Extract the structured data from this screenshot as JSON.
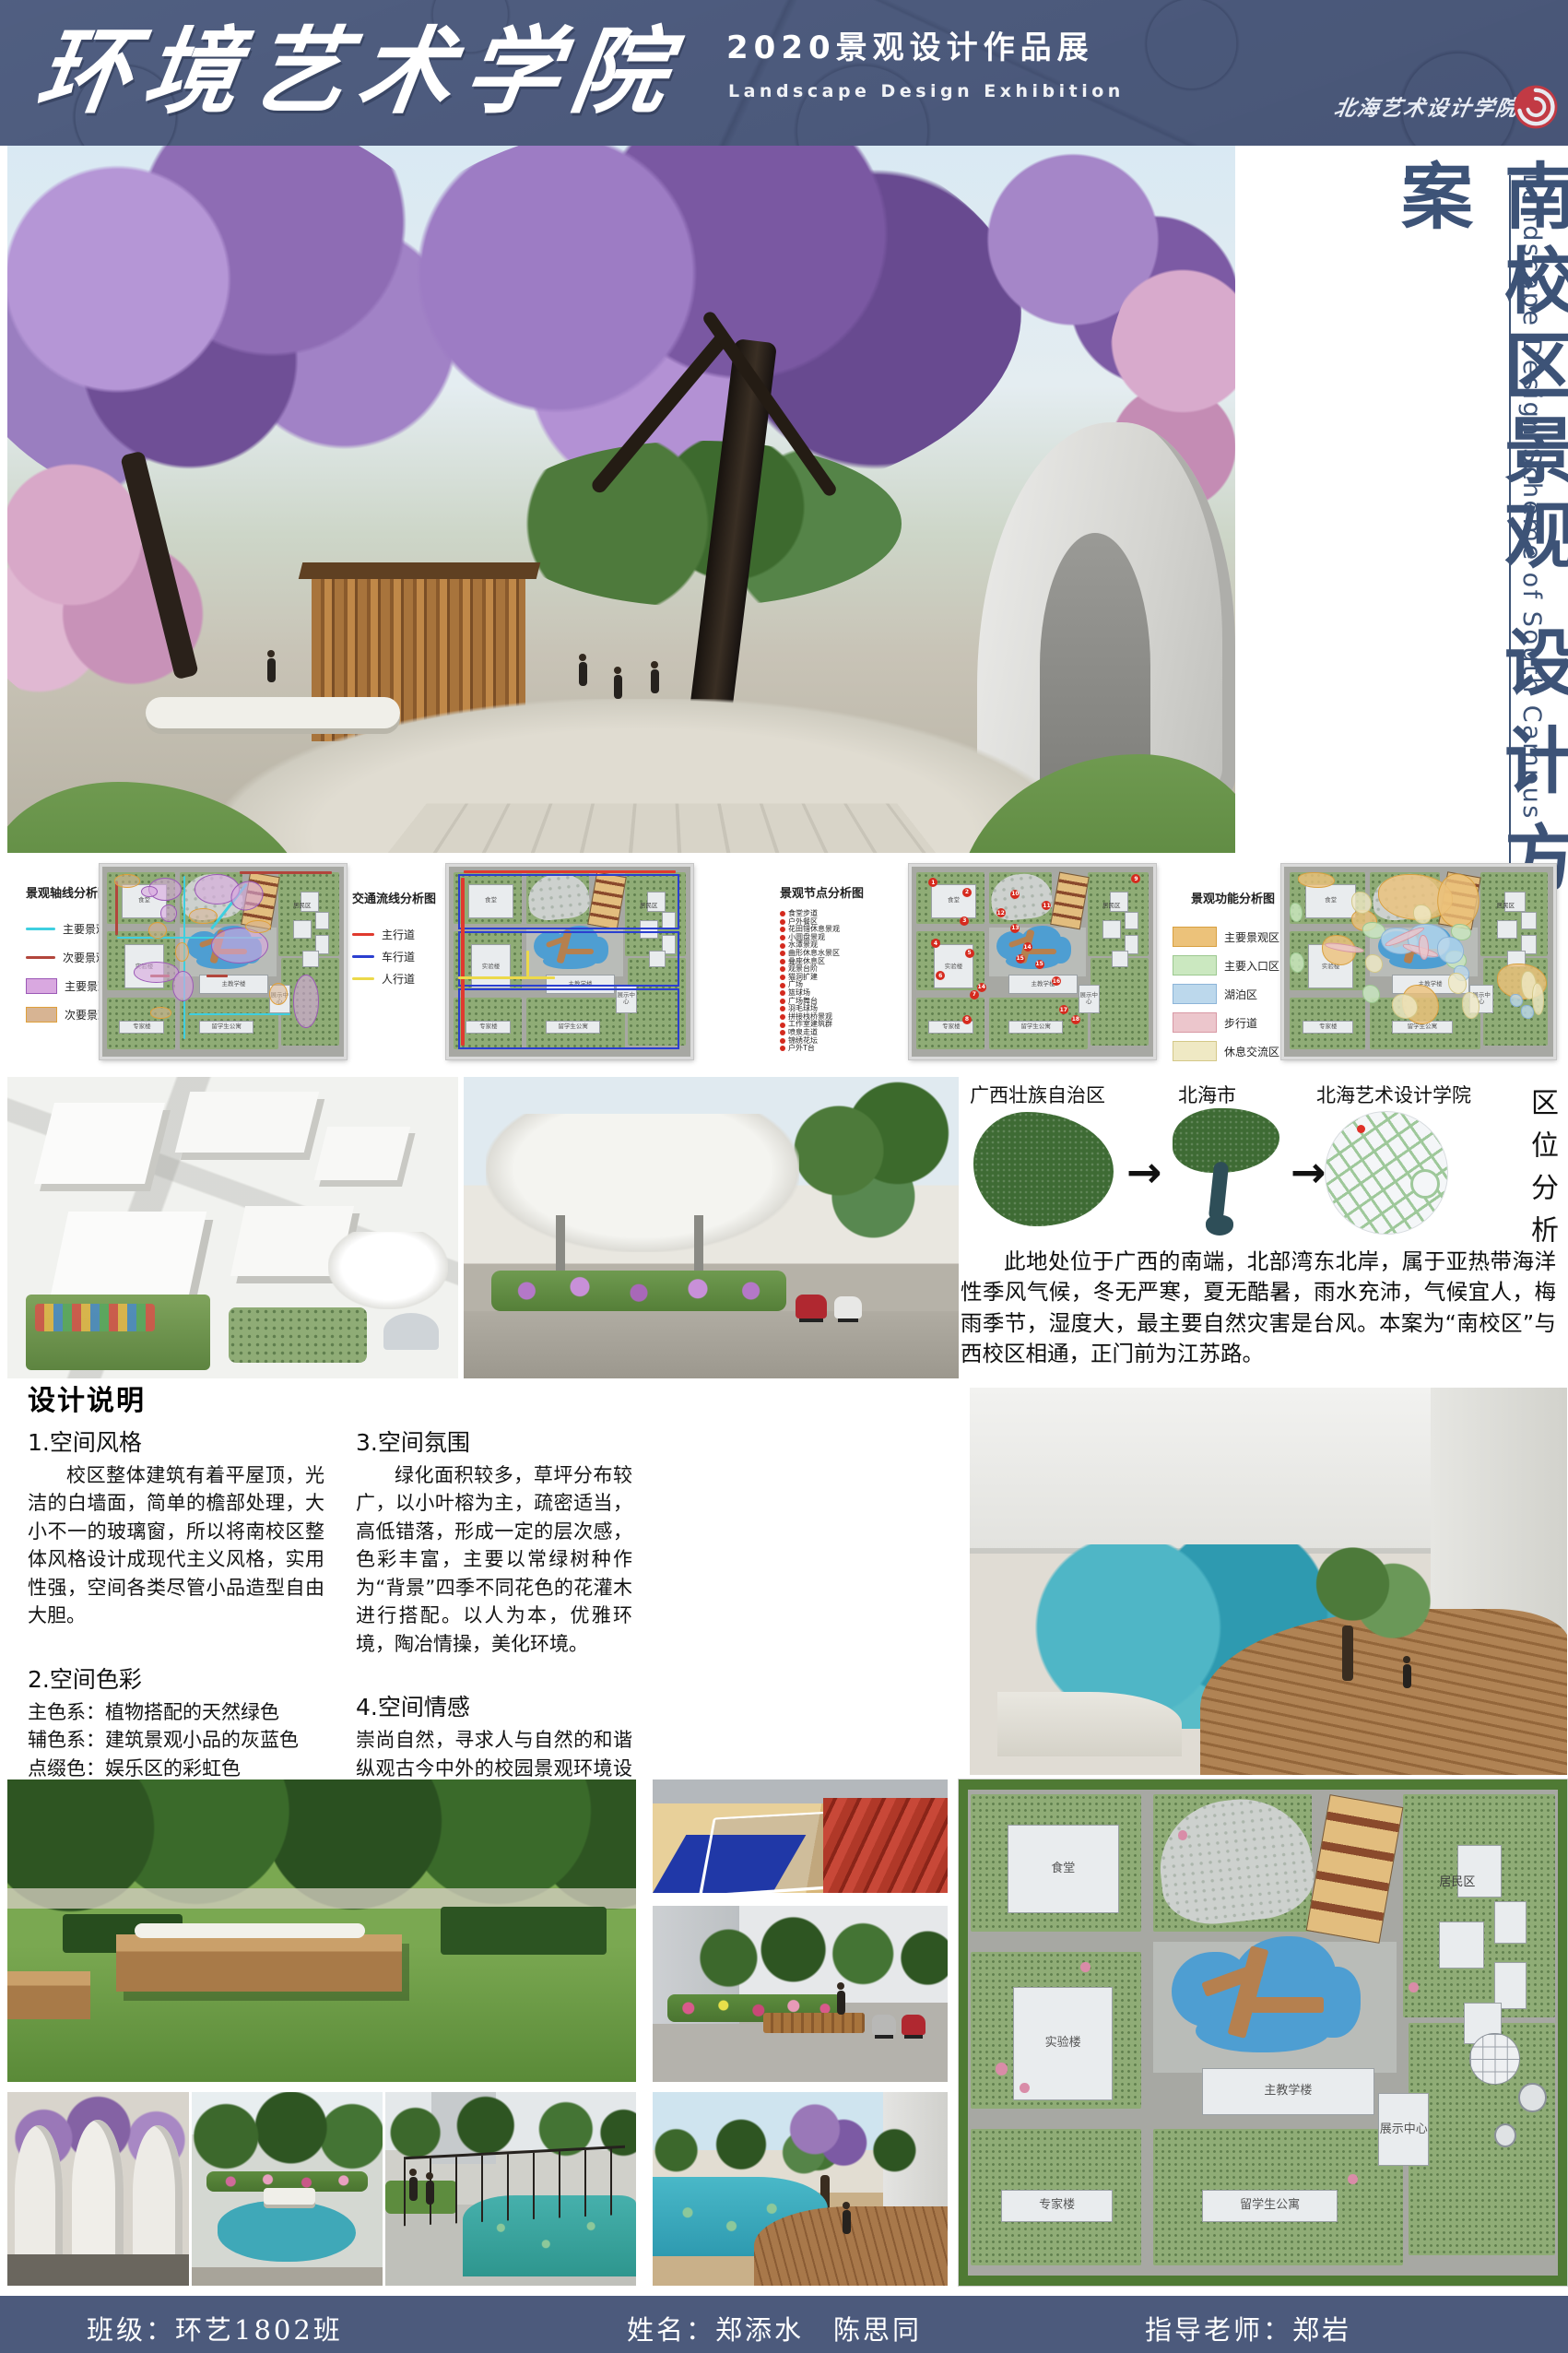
{
  "header": {
    "school_name": "环境艺术学院",
    "exhibition_title_zh": "2020景观设计作品展",
    "exhibition_title_en": "Landscape Design Exhibition",
    "logo_text": "北海艺术设计学院"
  },
  "side_title": {
    "zh_line1": "南校区景观",
    "zh_line2": "设计方案",
    "en": "Landscape Design Scheme of South Campus"
  },
  "icons": {
    "arrow_right": "→"
  },
  "diagrams": [
    {
      "title": "景观轴线分析图",
      "legend": [
        {
          "label": "主要景观轴线",
          "type": "line",
          "color": "#3ecfe0"
        },
        {
          "label": "次要景观轴线",
          "type": "line",
          "color": "#b2463c"
        },
        {
          "label": "主要景观节点",
          "type": "box",
          "color": "#d9a8e0",
          "border": "#9b59b6"
        },
        {
          "label": "次要景观节点",
          "type": "box",
          "color": "#d7b493",
          "border": "#e0a03a"
        }
      ]
    },
    {
      "title": "交通流线分析图",
      "legend": [
        {
          "label": "主行道",
          "type": "line",
          "color": "#e03a2e"
        },
        {
          "label": "车行道",
          "type": "line",
          "color": "#2b3fd0"
        },
        {
          "label": "人行道",
          "type": "line",
          "color": "#ecd94a"
        }
      ]
    },
    {
      "title": "景观节点分析图",
      "nodes": [
        "食堂步道",
        "户外餐区",
        "花田错休息景观",
        "小圆盘景观",
        "水潭景观",
        "曲形休息水景区",
        "叠座休息区",
        "观景台阶",
        "猫洞扩建",
        "广场",
        "篮球场",
        "广场舞台",
        "羽毛球场",
        "拼接栈桥景观",
        "工作室建筑群",
        "喷泉走道",
        "锦绣花坛",
        "户外T台"
      ]
    },
    {
      "title": "景观功能分析图",
      "legend": [
        {
          "label": "主要景观区",
          "type": "box",
          "color": "#ecc27a",
          "border": "#d8a040"
        },
        {
          "label": "主要入口区",
          "type": "box",
          "color": "#cbe8c0",
          "border": "#9cc890"
        },
        {
          "label": "湖泊区",
          "type": "box",
          "color": "#bcd8ec",
          "border": "#8cb4d8"
        },
        {
          "label": "步行道",
          "type": "box",
          "color": "#ecc6cc",
          "border": "#d898a4"
        },
        {
          "label": "休息交流区",
          "type": "box",
          "color": "#efe9c4",
          "border": "#d4c888"
        }
      ]
    }
  ],
  "plan_labels": {
    "canteen": "食堂",
    "lab": "实验楼",
    "main_teaching": "主教学楼",
    "expert": "专家楼",
    "intl_dorm": "留学生公寓",
    "exhibition_center": "展示中心",
    "residential": "居民区"
  },
  "location": {
    "title_vertical": "区位分析",
    "steps": [
      "广西壮族自治区",
      "北海市",
      "北海艺术设计学院"
    ],
    "description": "此地处位于广西的南端，北部湾东北岸，属于亚热带海洋性季风气候，冬无严寒，夏无酷暑，雨水充沛，气候宜人，梅雨季节，湿度大，最主要自然灾害是台风。本案为“南校区”与西校区相通，正门前为江苏路。"
  },
  "design_notes": {
    "title": "设计说明",
    "sections": [
      {
        "heading": "1.空间风格",
        "body": "校区整体建筑有着平屋顶，光洁的白墙面，简单的檐部处理，大小不一的玻璃窗，所以将南校区整体风格设计成现代主义风格，实用性强，空间各类尽管小品造型自由大胆。"
      },
      {
        "heading": "2.空间色彩",
        "body": "主色系：植物搭配的天然绿色\n辅色系：建筑景观小品的灰蓝色\n点缀色：娱乐区的彩虹色"
      },
      {
        "heading": "3.空间氛围",
        "body": "绿化面积较多，草坪分布较广，以小叶榕为主，疏密适当，高低错落，形成一定的层次感，色彩丰富，主要以常绿树种作为“背景”四季不同花色的花灌木进行搭配。以人为本，优雅环境，陶冶情操，美化环境。"
      },
      {
        "heading": "4.空间情感",
        "body": "崇尚自然，寻求人与自然的和谐纵观古今中外的校园景观环境设计，都以“接近自然，回归自然”作为设计法则。贯穿于整个设计与建造中。只有在有限的生活空间利用自然，师法自然，寻求人与山水，建筑小品，植物之间的和谐共处，才能使环境有融于自然之感，达到人和自然的和谐。"
      }
    ]
  },
  "footer": {
    "class_label": "班级：环艺1802班",
    "names_label": "姓名：郑添水　陈思同",
    "advisor_label": "指导老师：郑岩"
  },
  "colors": {
    "header_bg": "#4d5b7d",
    "footer_bg": "#4c5a7c",
    "title_navy": "#3d5377",
    "seal_red": "#c23a44"
  }
}
